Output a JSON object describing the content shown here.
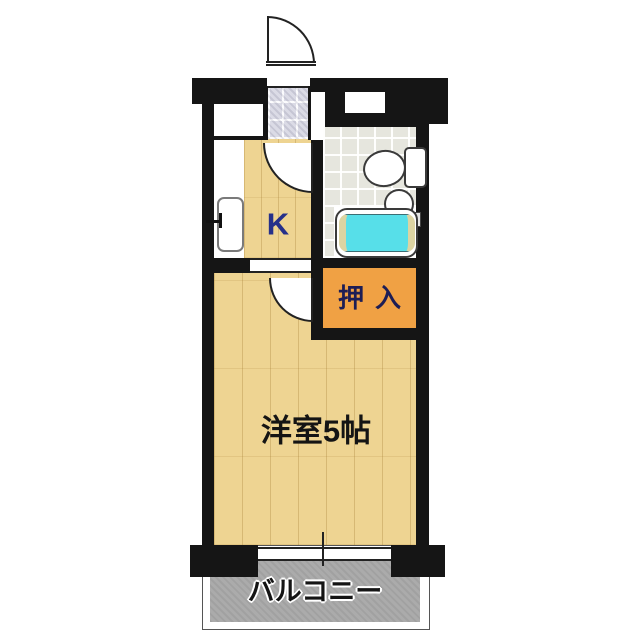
{
  "rooms": {
    "kitchen": {
      "label": "K"
    },
    "closet": {
      "label": "押入"
    },
    "main_room": {
      "label": "洋室5帖"
    },
    "balcony": {
      "label": "バルコニー"
    }
  },
  "symbols": [
    "entrance-door",
    "entrance-tiles",
    "kitchen-door",
    "room-door",
    "kitchen-sink",
    "toilet",
    "wash-basin",
    "bathtub",
    "balcony-window"
  ],
  "colors": {
    "wall": "#151515",
    "floor_tan": "#eed492",
    "closet_orange": "#f0a144",
    "closet_text": "#1d1d55",
    "kitchen_text": "#26308a",
    "text_black": "#141414",
    "bath_floor": "#e6e6de",
    "tub_cyan": "#57dfe9",
    "tub_rim": "#dcd4a2",
    "tile_gray": "#d9d9e4",
    "balcony_gray": "#ababab"
  }
}
